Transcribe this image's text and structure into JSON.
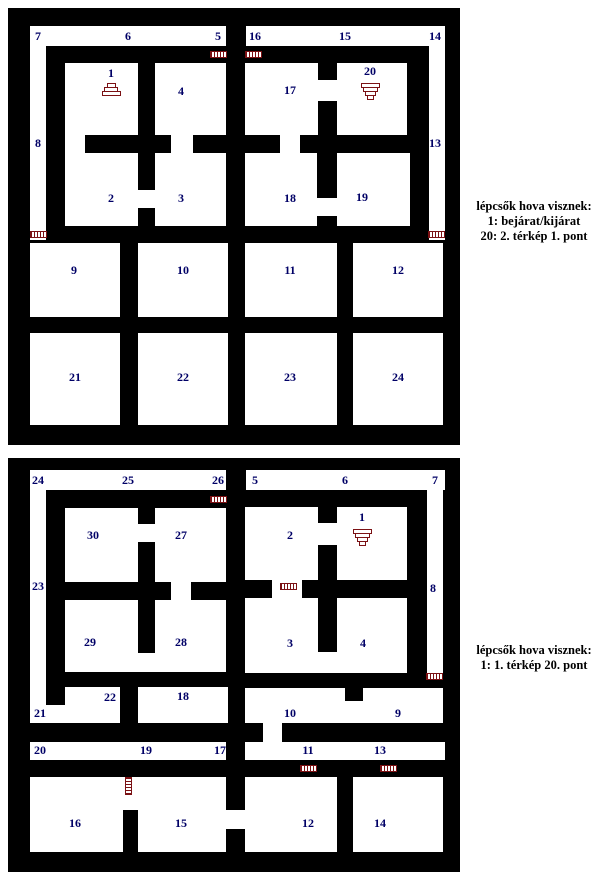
{
  "page": {
    "width": 608,
    "height": 880,
    "background": "#ffffff"
  },
  "colors": {
    "wall": "#000000",
    "floor": "#ffffff",
    "label": "#000066",
    "marker": "#7b1114",
    "legend_text": "#000000"
  },
  "maps": [
    {
      "name": "terkep-1",
      "box": {
        "left": 8,
        "top": 8,
        "width": 452,
        "height": 437
      },
      "floors": [
        [
          22,
          18,
          196,
          20
        ],
        [
          238,
          18,
          199,
          20
        ],
        [
          22,
          18,
          16,
          214
        ],
        [
          421,
          18,
          16,
          214
        ],
        [
          57,
          55,
          73,
          72
        ],
        [
          147,
          55,
          71,
          72
        ],
        [
          57,
          145,
          73,
          73
        ],
        [
          147,
          145,
          71,
          73
        ],
        [
          57,
          127,
          20,
          18
        ],
        [
          163,
          127,
          22,
          18
        ],
        [
          130,
          182,
          17,
          18
        ],
        [
          237,
          55,
          73,
          72
        ],
        [
          329,
          55,
          70,
          72
        ],
        [
          237,
          145,
          72,
          73
        ],
        [
          329,
          145,
          73,
          73
        ],
        [
          310,
          72,
          19,
          21
        ],
        [
          272,
          127,
          20,
          18
        ],
        [
          309,
          190,
          20,
          18
        ],
        [
          22,
          235,
          90,
          74
        ],
        [
          130,
          235,
          90,
          74
        ],
        [
          237,
          235,
          92,
          74
        ],
        [
          345,
          235,
          90,
          74
        ],
        [
          22,
          325,
          90,
          92
        ],
        [
          130,
          325,
          90,
          92
        ],
        [
          237,
          325,
          92,
          92
        ],
        [
          345,
          325,
          90,
          92
        ]
      ],
      "walls": [],
      "doors": [
        {
          "x": 202,
          "y": 43,
          "o": "h"
        },
        {
          "x": 237,
          "y": 43,
          "o": "h"
        },
        {
          "x": 22,
          "y": 223,
          "o": "h"
        },
        {
          "x": 420,
          "y": 223,
          "o": "h"
        }
      ],
      "stairs": [
        {
          "x": 103,
          "y": 84,
          "dir": "up"
        },
        {
          "x": 362,
          "y": 84,
          "dir": "down"
        }
      ],
      "labels": [
        {
          "t": "7",
          "x": 30,
          "y": 28
        },
        {
          "t": "6",
          "x": 120,
          "y": 28
        },
        {
          "t": "5",
          "x": 210,
          "y": 28
        },
        {
          "t": "16",
          "x": 247,
          "y": 28
        },
        {
          "t": "15",
          "x": 337,
          "y": 28
        },
        {
          "t": "14",
          "x": 427,
          "y": 28
        },
        {
          "t": "8",
          "x": 30,
          "y": 135
        },
        {
          "t": "13",
          "x": 427,
          "y": 135
        },
        {
          "t": "1",
          "x": 103,
          "y": 65
        },
        {
          "t": "4",
          "x": 173,
          "y": 83
        },
        {
          "t": "17",
          "x": 282,
          "y": 82
        },
        {
          "t": "20",
          "x": 362,
          "y": 63
        },
        {
          "t": "2",
          "x": 103,
          "y": 190
        },
        {
          "t": "3",
          "x": 173,
          "y": 190
        },
        {
          "t": "18",
          "x": 282,
          "y": 190
        },
        {
          "t": "19",
          "x": 354,
          "y": 189
        },
        {
          "t": "9",
          "x": 66,
          "y": 262
        },
        {
          "t": "10",
          "x": 175,
          "y": 262
        },
        {
          "t": "11",
          "x": 282,
          "y": 262
        },
        {
          "t": "12",
          "x": 390,
          "y": 262
        },
        {
          "t": "21",
          "x": 67,
          "y": 369
        },
        {
          "t": "22",
          "x": 175,
          "y": 369
        },
        {
          "t": "23",
          "x": 282,
          "y": 369
        },
        {
          "t": "24",
          "x": 390,
          "y": 369
        }
      ],
      "legend": {
        "x": 460,
        "y": 199,
        "lines": [
          "lépcsők hova visznek:",
          "1: bejárat/kijárat",
          "20: 2. térkép 1. pont"
        ]
      }
    },
    {
      "name": "terkep-2",
      "box": {
        "left": 8,
        "top": 458,
        "width": 452,
        "height": 414
      },
      "floors": [
        [
          22,
          12,
          196,
          20
        ],
        [
          238,
          12,
          199,
          20
        ],
        [
          22,
          12,
          16,
          253
        ],
        [
          419,
          12,
          16,
          210
        ],
        [
          57,
          50,
          73,
          74
        ],
        [
          147,
          50,
          71,
          74
        ],
        [
          130,
          66,
          17,
          18
        ],
        [
          163,
          124,
          20,
          18
        ],
        [
          57,
          142,
          73,
          72
        ],
        [
          147,
          142,
          71,
          72
        ],
        [
          130,
          195,
          17,
          19
        ],
        [
          237,
          49,
          73,
          73
        ],
        [
          329,
          49,
          70,
          73
        ],
        [
          310,
          65,
          19,
          22
        ],
        [
          264,
          122,
          30,
          18
        ],
        [
          237,
          140,
          73,
          75
        ],
        [
          329,
          140,
          70,
          75
        ],
        [
          310,
          194,
          19,
          21
        ],
        [
          57,
          229,
          55,
          36
        ],
        [
          22,
          247,
          90,
          18
        ],
        [
          130,
          229,
          90,
          36
        ],
        [
          237,
          230,
          198,
          35
        ],
        [
          255,
          265,
          19,
          19
        ],
        [
          22,
          284,
          196,
          18
        ],
        [
          237,
          284,
          200,
          18
        ],
        [
          22,
          319,
          93,
          75
        ],
        [
          115,
          319,
          15,
          33
        ],
        [
          130,
          319,
          88,
          75
        ],
        [
          218,
          352,
          19,
          19
        ],
        [
          237,
          319,
          92,
          75
        ],
        [
          345,
          319,
          90,
          75
        ]
      ],
      "walls": [
        [
          337,
          230,
          18,
          13
        ]
      ],
      "doors": [
        {
          "x": 202,
          "y": 38,
          "o": "h"
        },
        {
          "x": 272,
          "y": 125,
          "o": "h"
        },
        {
          "x": 418,
          "y": 215,
          "o": "h"
        },
        {
          "x": 292,
          "y": 307,
          "o": "h"
        },
        {
          "x": 372,
          "y": 307,
          "o": "h"
        },
        {
          "x": 117,
          "y": 319,
          "o": "v"
        }
      ],
      "stairs": [
        {
          "x": 354,
          "y": 80,
          "dir": "down"
        }
      ],
      "labels": [
        {
          "t": "24",
          "x": 30,
          "y": 22
        },
        {
          "t": "25",
          "x": 120,
          "y": 22
        },
        {
          "t": "26",
          "x": 210,
          "y": 22
        },
        {
          "t": "5",
          "x": 247,
          "y": 22
        },
        {
          "t": "6",
          "x": 337,
          "y": 22
        },
        {
          "t": "7",
          "x": 427,
          "y": 22
        },
        {
          "t": "23",
          "x": 30,
          "y": 128
        },
        {
          "t": "8",
          "x": 425,
          "y": 130
        },
        {
          "t": "30",
          "x": 85,
          "y": 77
        },
        {
          "t": "27",
          "x": 173,
          "y": 77
        },
        {
          "t": "2",
          "x": 282,
          "y": 77
        },
        {
          "t": "1",
          "x": 354,
          "y": 59
        },
        {
          "t": "29",
          "x": 82,
          "y": 184
        },
        {
          "t": "28",
          "x": 173,
          "y": 184
        },
        {
          "t": "3",
          "x": 282,
          "y": 185
        },
        {
          "t": "4",
          "x": 355,
          "y": 185
        },
        {
          "t": "21",
          "x": 32,
          "y": 255
        },
        {
          "t": "22",
          "x": 102,
          "y": 239
        },
        {
          "t": "18",
          "x": 175,
          "y": 238
        },
        {
          "t": "10",
          "x": 282,
          "y": 255
        },
        {
          "t": "9",
          "x": 390,
          "y": 255
        },
        {
          "t": "20",
          "x": 32,
          "y": 292
        },
        {
          "t": "19",
          "x": 138,
          "y": 292
        },
        {
          "t": "17",
          "x": 212,
          "y": 292
        },
        {
          "t": "11",
          "x": 300,
          "y": 292
        },
        {
          "t": "13",
          "x": 372,
          "y": 292
        },
        {
          "t": "16",
          "x": 67,
          "y": 365
        },
        {
          "t": "15",
          "x": 173,
          "y": 365
        },
        {
          "t": "12",
          "x": 300,
          "y": 365
        },
        {
          "t": "14",
          "x": 372,
          "y": 365
        }
      ],
      "legend": {
        "x": 460,
        "y": 643,
        "lines": [
          "lépcsők hova visznek:",
          "1: 1. térkép 20. pont"
        ]
      }
    }
  ]
}
